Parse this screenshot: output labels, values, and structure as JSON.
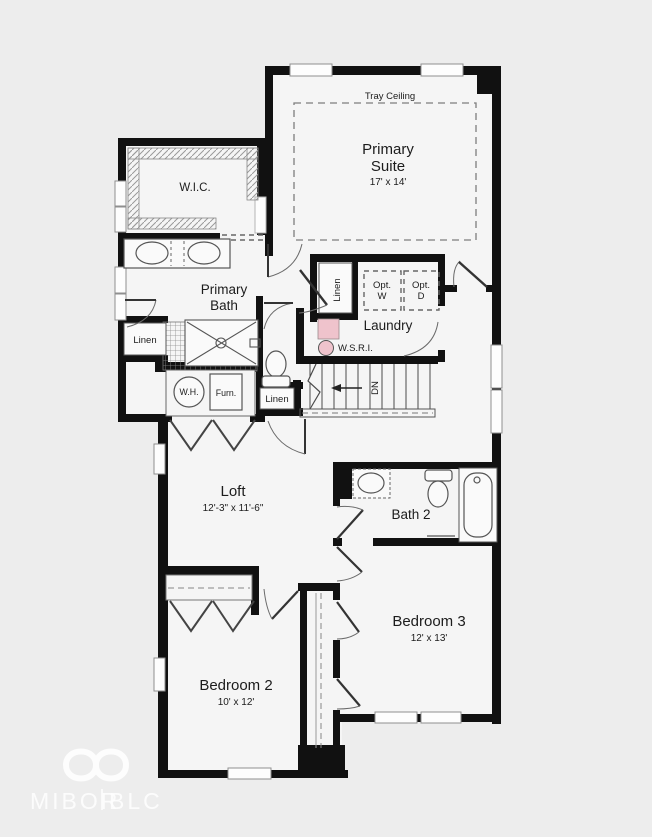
{
  "plan": {
    "rooms": {
      "primary_suite": {
        "line1": "Primary",
        "line2": "Suite",
        "dims": "17' x 14'",
        "ceiling": "Tray Ceiling"
      },
      "wic": {
        "label": "W.I.C."
      },
      "primary_bath": {
        "line1": "Primary",
        "line2": "Bath"
      },
      "laundry": {
        "label": "Laundry"
      },
      "loft": {
        "label": "Loft",
        "dims": "12'-3\" x 11'-6\""
      },
      "bath_2": {
        "label": "Bath 2"
      },
      "bedroom_3": {
        "label": "Bedroom 3",
        "dims": "12' x 13'"
      },
      "bedroom_2": {
        "label": "Bedroom 2",
        "dims": "10' x 12'"
      }
    },
    "closets": {
      "linen_primary_bath": "Linen",
      "linen_laundry": "Linen",
      "linen_hall": "Linen"
    },
    "labels": {
      "water_heater": "W.H.",
      "furnace": "Furn.",
      "opt_washer_l1": "Opt.",
      "opt_washer_l2": "W",
      "opt_dryer_l1": "Opt.",
      "opt_dryer_l2": "D",
      "wsri": "W.S.R.I.",
      "stairs_dn": "DN"
    },
    "watermark": {
      "brand_left": "MIBOR",
      "brand_right": "BLC"
    },
    "colors": {
      "wall": "#111111",
      "background": "#ededed",
      "floor": "#f5f5f5",
      "accent_pink": "#efc3cc",
      "watermark": "#ffffff"
    }
  }
}
